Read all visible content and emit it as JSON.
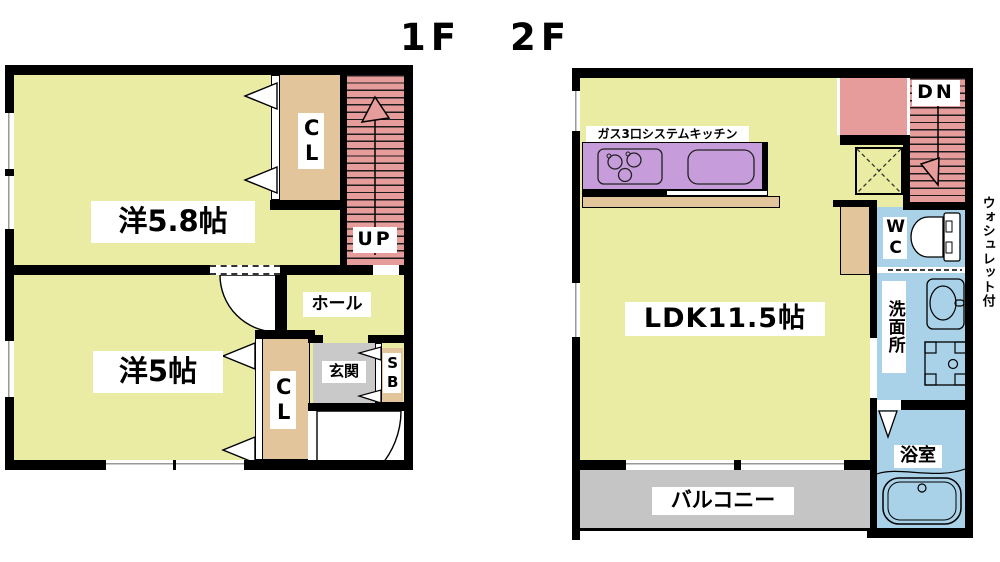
{
  "titles": {
    "floor1": "1F",
    "floor2": "2F"
  },
  "floor1": {
    "room1_label": "洋5.8帖",
    "closet1_label": "CL",
    "stairs_label": "UP",
    "hall_label": "ホール",
    "room2_label": "洋5帖",
    "closet2_label": "CL",
    "entrance_label": "玄関",
    "shoebox_label": "SB"
  },
  "floor2": {
    "kitchen_label": "ガス3口システムキッチン",
    "stairs_label": "DN",
    "ldk_label": "LDK11.5帖",
    "wc_label": "WC",
    "washroom_label": "洗面所",
    "bathroom_label": "浴室",
    "balcony_label": "バルコニー",
    "washlet_note": "ウォシュレット付"
  },
  "icons": [
    "stove-icon",
    "kitchen-sink-icon",
    "toilet-icon",
    "washbasin-icon",
    "washing-machine-icon",
    "bathtub-icon",
    "stairs-up-arrow-icon",
    "stairs-down-arrow-icon",
    "door-swing-icon",
    "closet-door-icon",
    "void-x-icon"
  ],
  "colors": {
    "room": "#e9eca2",
    "closet": "#e3c59c",
    "stairs": "#e79c9c",
    "kitchen_counter": "#c79cdb",
    "water_rooms": "#a9d2e8",
    "entrance": "#c9c9c9",
    "balcony": "#c5c5c5",
    "wall": "#000000"
  }
}
